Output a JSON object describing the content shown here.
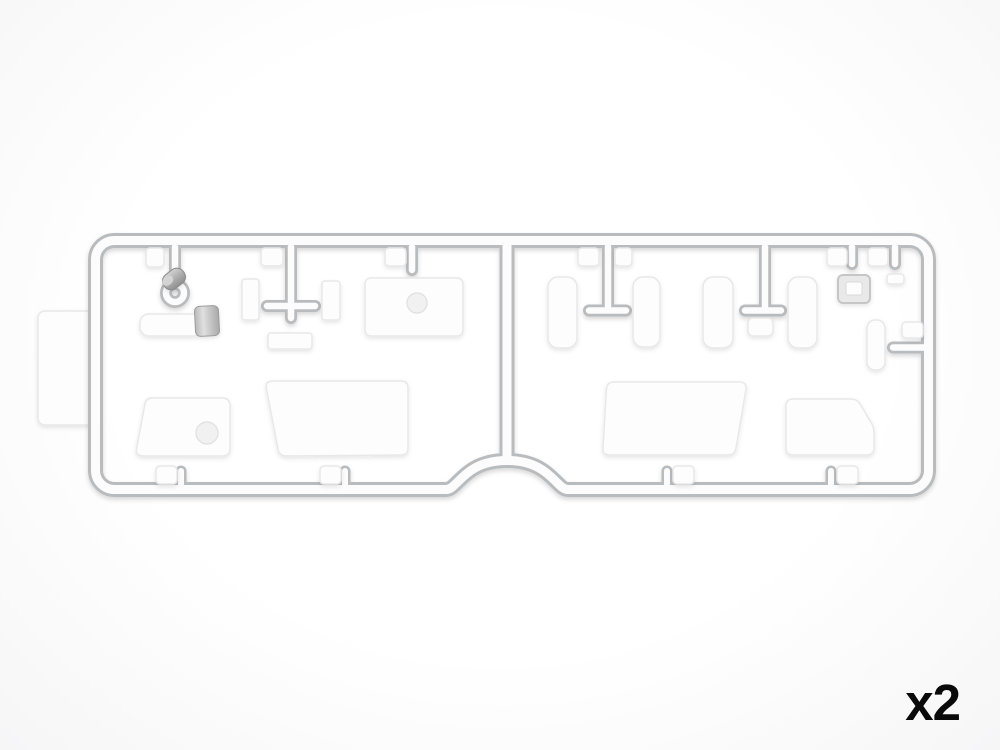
{
  "scene": {
    "quantity_label": "x2"
  },
  "colors": {
    "background_edge": "#f6f6f7",
    "runner_edge": "#b9bcbe",
    "runner_fill": "#fcfcfd",
    "part_fill": "#fdfdfd",
    "part_edge": "#e8e8e9",
    "hole_fill": "#f1f1f1",
    "metal_dark": "#8f8f8f",
    "metal_mid": "#a9a9a9",
    "metal_light": "#d2d2d2",
    "label_color": "#0a0a0a"
  },
  "objects": {
    "type": "injection-molded-sprue-render",
    "sections": 2,
    "parts": [
      "side-mount-tab",
      "cylinder-cap",
      "barrel-sleeve-with-collar",
      "small-plate-vertical-left",
      "small-plate-vertical-right",
      "small-plate-horizontal",
      "panel-with-hole",
      "angled-flap-left-with-hole",
      "large-panel-left",
      "pad-pill-1",
      "pad-pill-2",
      "pad-pill-3",
      "pad-pill-4",
      "under-gate-tab",
      "hatch-frame-with-opening",
      "small-chip",
      "small-pad-right",
      "rail-tab-right",
      "large-panel-right",
      "angled-flap-right",
      "molding-tabs"
    ]
  }
}
